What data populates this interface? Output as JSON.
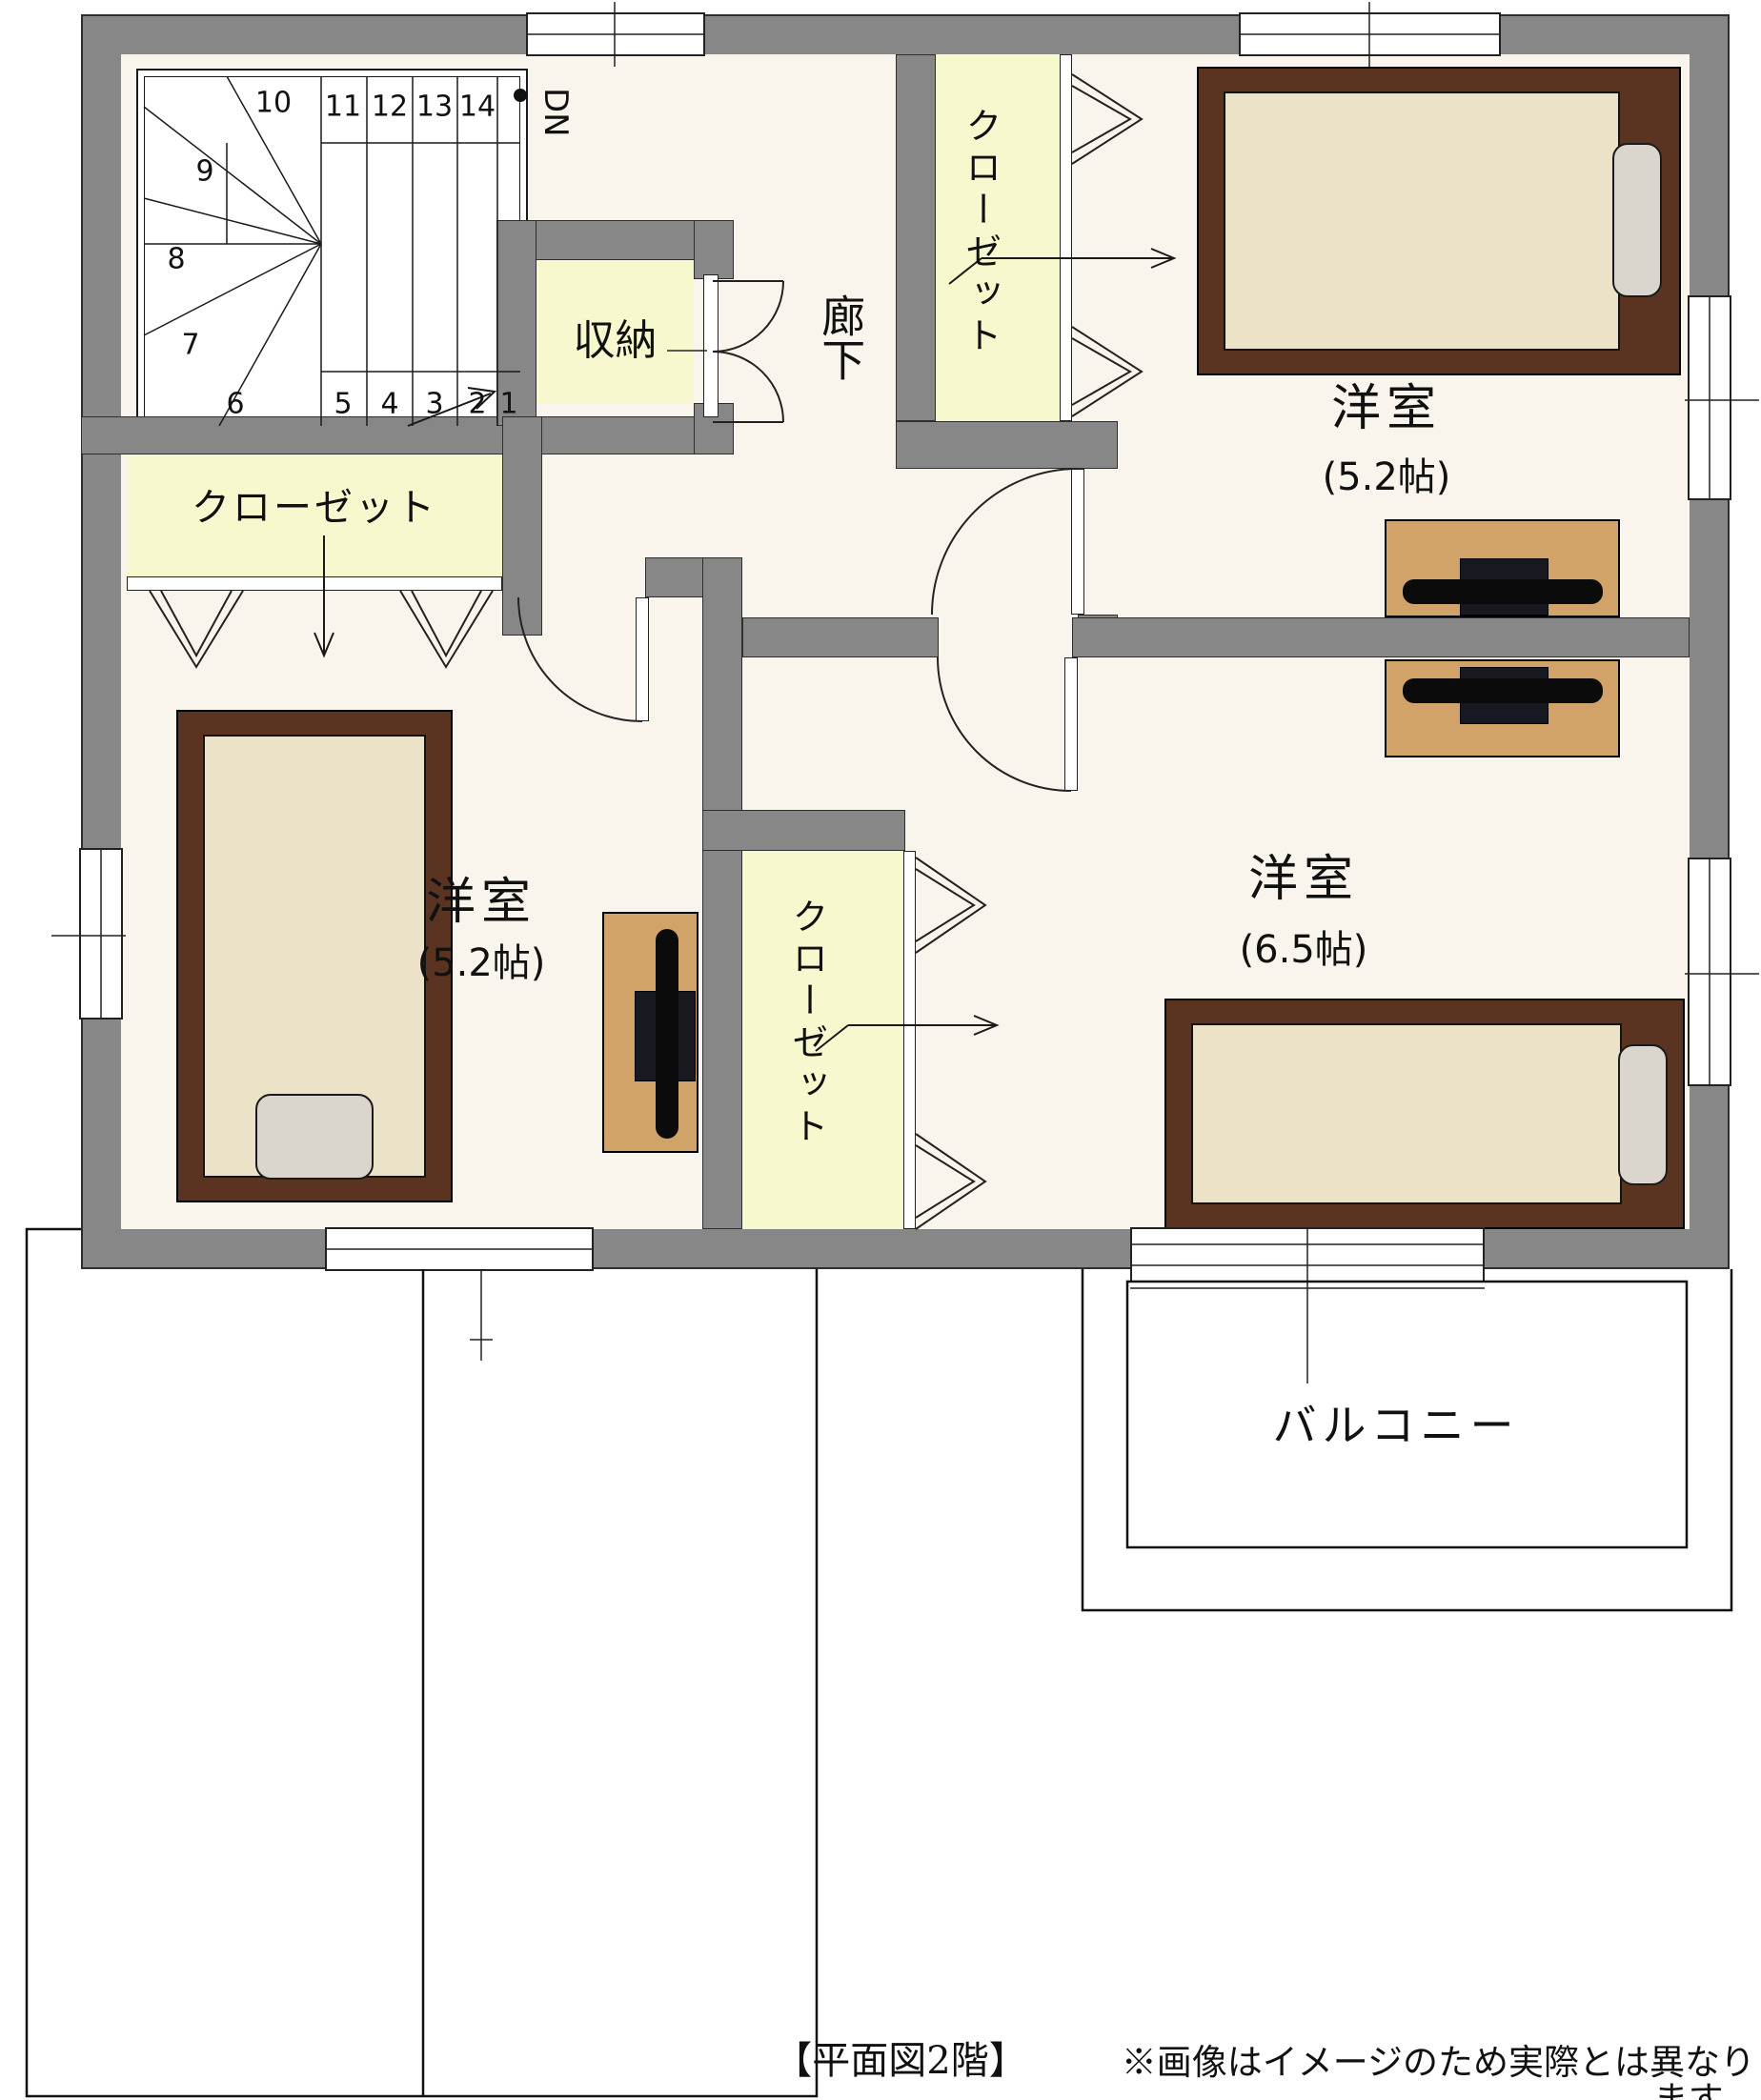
{
  "captions": {
    "title": "【平面図2階】",
    "disclaimer": "※画像はイメージのため実際とは異なります。"
  },
  "labels": {
    "dn": "DN",
    "storage": "収納",
    "hallway": "廊下",
    "closet": "クローゼット",
    "balcony": "バルコニー"
  },
  "rooms": [
    {
      "name": "洋室",
      "size": "(5.2帖)",
      "location": "top-right"
    },
    {
      "name": "洋室",
      "size": "(5.2帖)",
      "location": "bottom-left"
    },
    {
      "name": "洋室",
      "size": "(6.5帖)",
      "location": "bottom-right"
    }
  ],
  "stairs": {
    "direction": "DN",
    "steps": [
      "1",
      "2",
      "3",
      "4",
      "5",
      "6",
      "7",
      "8",
      "9",
      "10",
      "11",
      "12",
      "13",
      "14"
    ]
  },
  "colors": {
    "wall": "#878787",
    "floor": "#faf5ec",
    "closet_fill": "#f8f8cf",
    "bed_frame": "#5a3421",
    "mattress": "#ece2c8",
    "pillow": "#dad6ce",
    "desk": "#d2a368",
    "line": "#1a1a1a"
  }
}
